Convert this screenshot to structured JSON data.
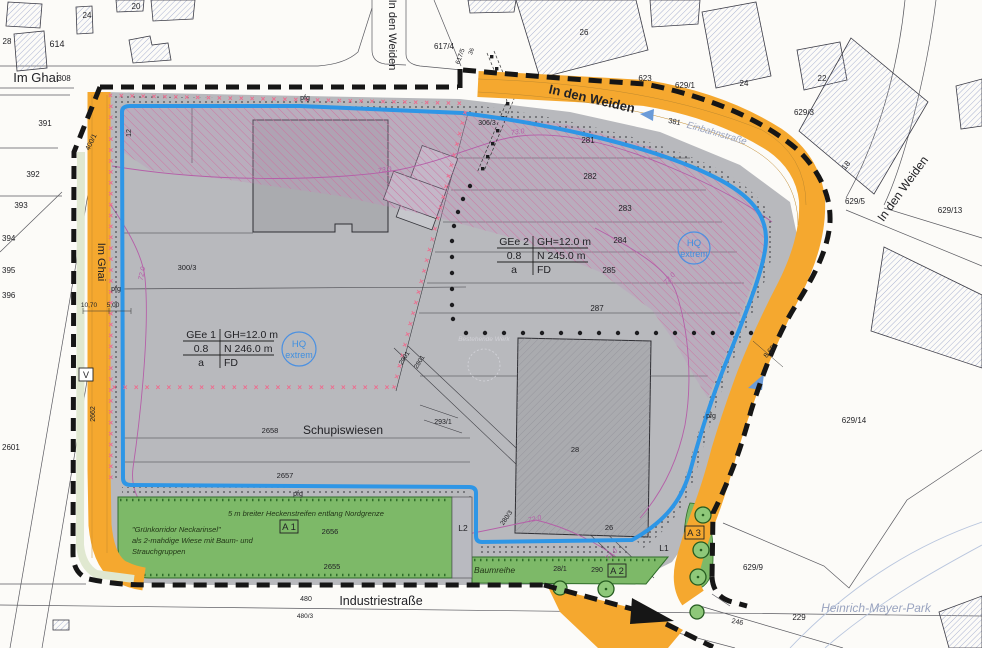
{
  "streets": {
    "im_ghai": "Im Ghai",
    "im_ghai_vertical": "Im Ghai",
    "in_den_weiden_top": "In den Weiden",
    "in_den_weiden_road": "In den Weiden",
    "in_den_weiden_right": "In den Weiden",
    "einbahnstrasse": "Einbahnstraße",
    "industriestrasse": "Industriestraße",
    "heinrich_mayer_park": "Heinrich-Mayer-Park"
  },
  "zoning": {
    "gee1": {
      "name": "GEe 1",
      "gh": "GH=12.0 m",
      "grz": "0.8",
      "height": "N  246.0 m",
      "row3_left": "a",
      "roof": "FD"
    },
    "gee2": {
      "name": "GEe 2",
      "gh": "GH=12.0 m",
      "grz": "0.8",
      "height": "N  245.0 m",
      "row3_left": "a",
      "roof": "FD"
    },
    "hq_line1": "HQ",
    "hq_line2": "extrem"
  },
  "green": {
    "hedge_note": "5 m breiter Heckenstreifen entlang Nordgrenze",
    "corridor_line1": "\"Grünkorridor Neckarinsel\"",
    "corridor_line2": "als 2-mahdige Wiese mit Baum- und",
    "corridor_line3": "Strauchgruppen",
    "baumreihe": "Baumreihe"
  },
  "labels": {
    "schupiswiesen": "Schupiswiesen",
    "bestehende": "Bestehende Werk"
  },
  "markers": {
    "a1": "A 1",
    "a2": "A 2",
    "a3": "A 3",
    "l1": "L1",
    "l2": "L2",
    "v": "V"
  },
  "dims": {
    "d_road": "10,70",
    "d_strip": "5,00",
    "d_right": "8.65"
  },
  "contours": {
    "c72": "72.0",
    "c73": "73.0"
  },
  "misc": {
    "pfg": "pfg",
    "x_mark": "×"
  },
  "parcels": {
    "p28": "28",
    "p614": "614",
    "p24": "24",
    "p20": "20",
    "p308": "308",
    "p391": "391",
    "p392": "392",
    "p393": "393",
    "p394": "394",
    "p395": "395",
    "p396": "396",
    "p2601": "2601",
    "p400_1": "400/1",
    "p12": "12",
    "p2662": "2662",
    "p617_4": "617/4",
    "p617_5": "617/5",
    "p36": "36",
    "p26_top": "26",
    "p623": "623",
    "p629_1": "629/1",
    "p24_b": "24",
    "p22": "22",
    "p629_3": "629/3",
    "p18": "18",
    "p629_5": "629/5",
    "p629_13": "629/13",
    "p629_14": "629/14",
    "p629_9": "629/9",
    "p229": "229",
    "p246": "246",
    "p381": "381",
    "p306_3": "306/3",
    "p281": "281",
    "p282": "282",
    "p283": "283",
    "p284": "284",
    "p285": "285",
    "p287": "287",
    "p300_3": "300/3",
    "p2658": "2658",
    "p2657": "2657",
    "p2656": "2656",
    "p2655": "2655",
    "p293_1": "293/1",
    "p2901": "2901",
    "p2801": "2801",
    "p280_3": "280/3",
    "p28_1": "28/1",
    "p290": "290",
    "p26_b": "26",
    "p28_b": "28",
    "p480": "480",
    "p480_3": "480/3"
  }
}
